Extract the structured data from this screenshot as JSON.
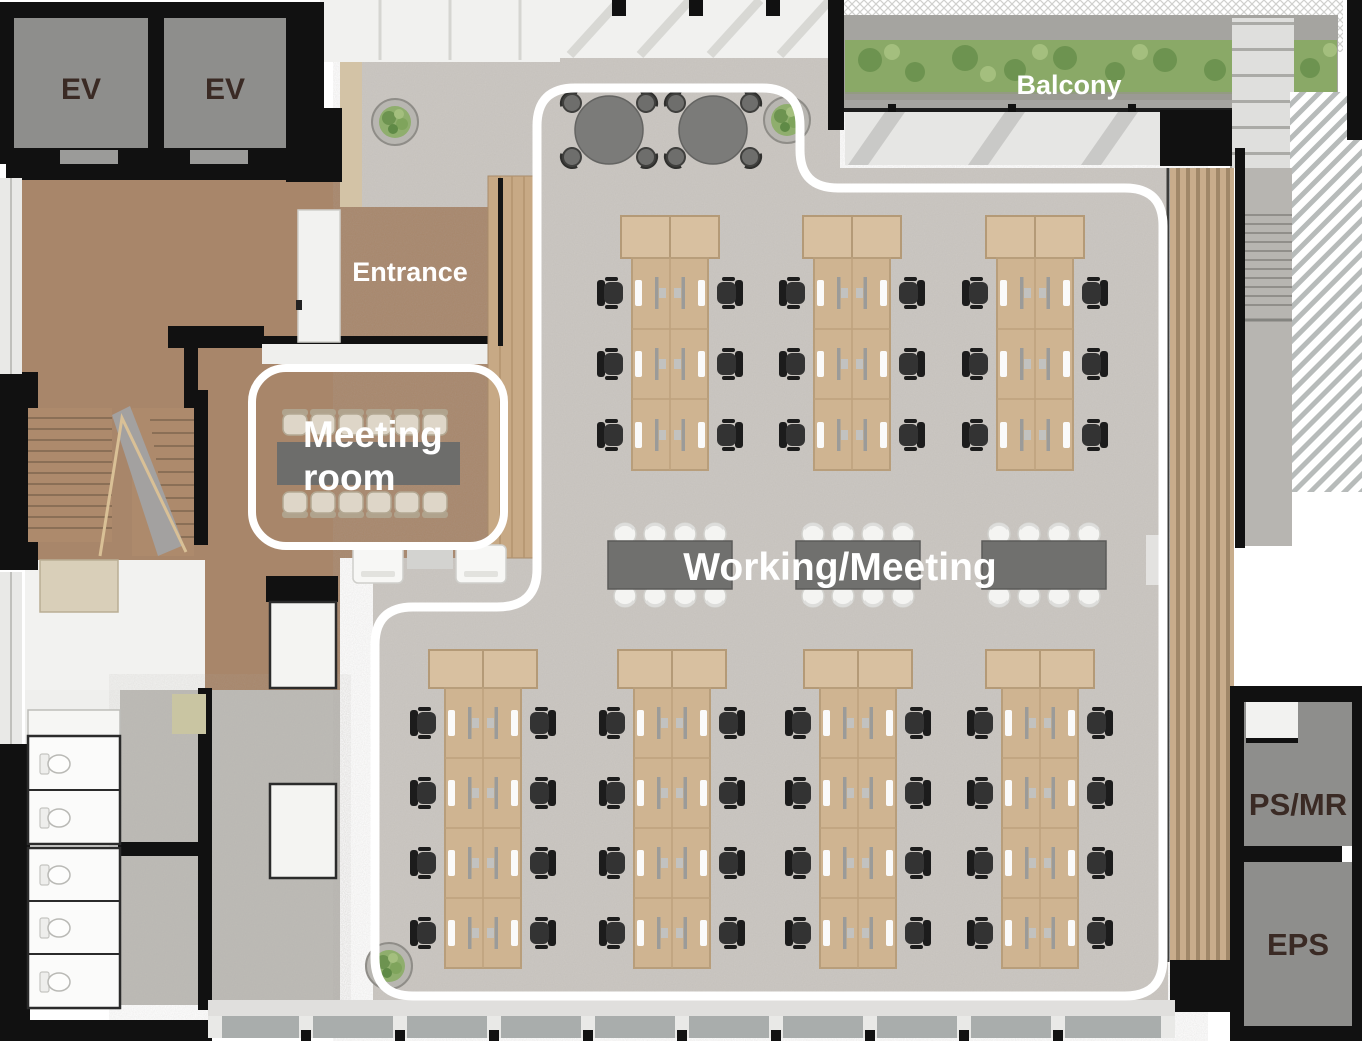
{
  "title": "Office floor plan",
  "rooms": {
    "ev1": {
      "label": "EV"
    },
    "ev2": {
      "label": "EV"
    },
    "balcony": {
      "label": "Balcony"
    },
    "entrance": {
      "label": "Entrance"
    },
    "meeting_room": {
      "label_line1": "Meeting",
      "label_line2": "room"
    },
    "working_meeting": {
      "label": "Working/Meeting"
    },
    "ps_mr": {
      "label": "PS/MR"
    },
    "eps": {
      "label": "EPS"
    }
  },
  "furniture": {
    "round_tables": 2,
    "chairs_per_round_table": 4,
    "top_desk_clusters": 3,
    "seats_per_top_cluster": 6,
    "bottom_desk_clusters": 4,
    "seats_per_bottom_cluster": 8,
    "center_meeting_tables": 3,
    "chairs_per_center_table": 8,
    "meeting_room_chairs": 12,
    "printers": 2,
    "plants": 3,
    "toilet_stalls": 5
  },
  "colors": {
    "wall": "#111111",
    "service_room_fill": "#8e8e8c",
    "room_label_text": "#3a2a24",
    "floor_label_text": "#ffffff",
    "wood_floor": "#a8866a",
    "desk_wood": "#cfb491",
    "carpet": "#ccc8c3",
    "balcony_floor": "#a5a4a0",
    "meeting_table": "#70706e",
    "office_chair": "#2f2f2f",
    "white_chair": "#f4f4f2",
    "hedge_green": "#8aa967",
    "zone_outline": "#ffffff"
  }
}
